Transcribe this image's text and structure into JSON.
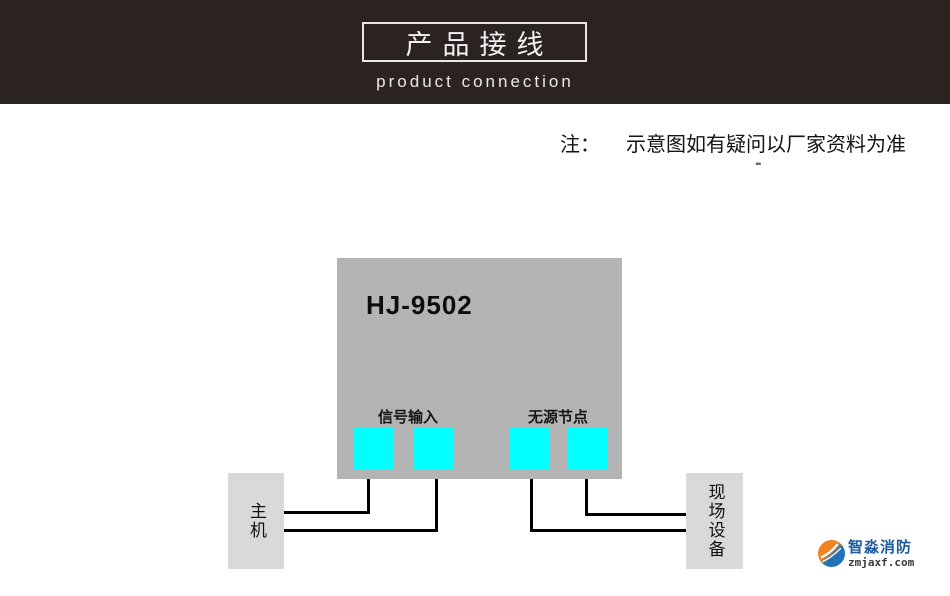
{
  "header": {
    "title": "产品接线",
    "subtitle": "product connection"
  },
  "note": {
    "prefix": "注：",
    "text": "示意图如有疑问以厂家资料为准",
    "dash": "-"
  },
  "device": {
    "model": "HJ-9502",
    "groups": [
      {
        "label": "信号输入"
      },
      {
        "label": "无源节点"
      }
    ]
  },
  "boxes": {
    "left": {
      "label": "主机"
    },
    "right": {
      "label": "现场设备"
    }
  },
  "logo": {
    "name": "智淼消防",
    "domain": "zmjaxf.com"
  },
  "colors": {
    "header_bg": "#2a2322",
    "panel_gray": "#b4b4b4",
    "terminal_cyan": "#00ffff",
    "box_gray": "#d9d9d9",
    "line_black": "#000000",
    "logo_blue": "#1d5d9f",
    "logo_orange": "#f08420"
  }
}
